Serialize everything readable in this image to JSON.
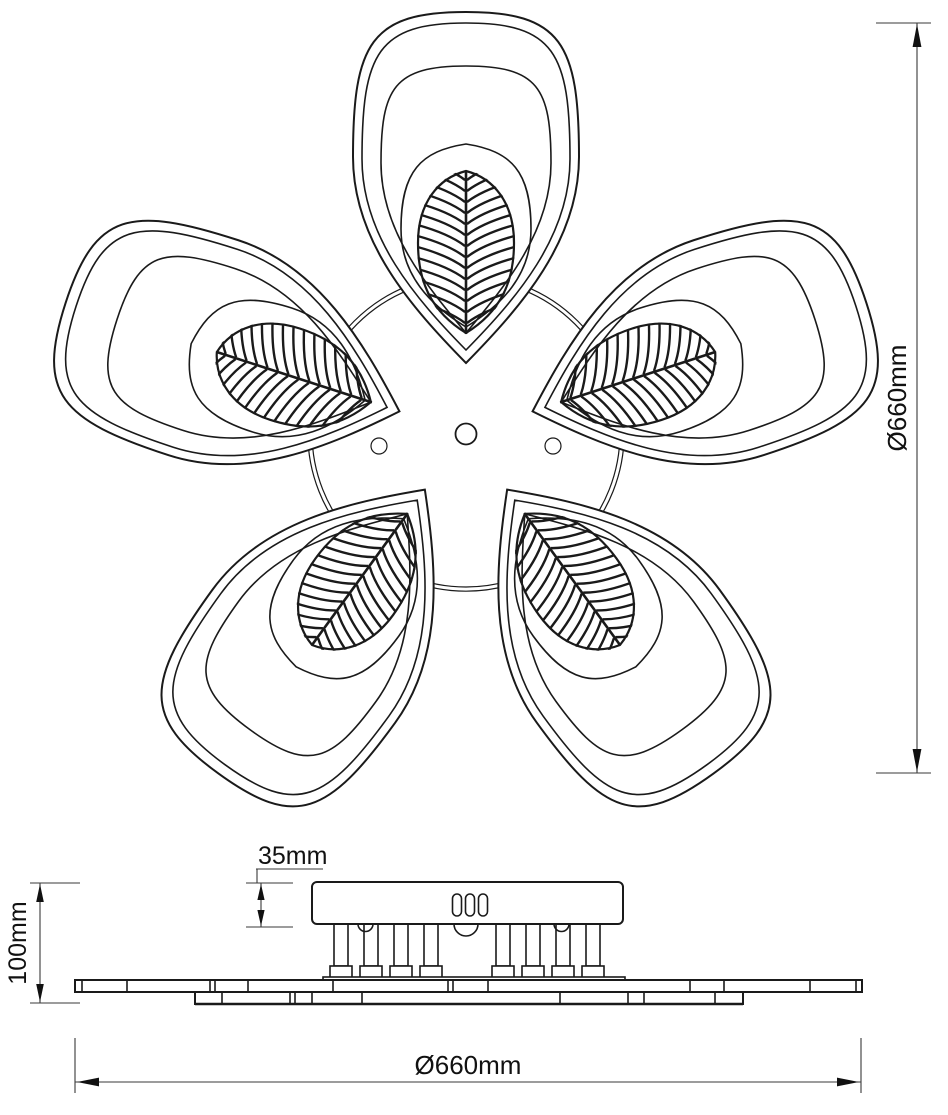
{
  "diagram": {
    "dimensions": {
      "overall_diameter_right": "Ø660mm",
      "overall_diameter_bottom": "Ø660mm",
      "canopy_height": "35mm",
      "fixture_height": "100mm"
    }
  }
}
